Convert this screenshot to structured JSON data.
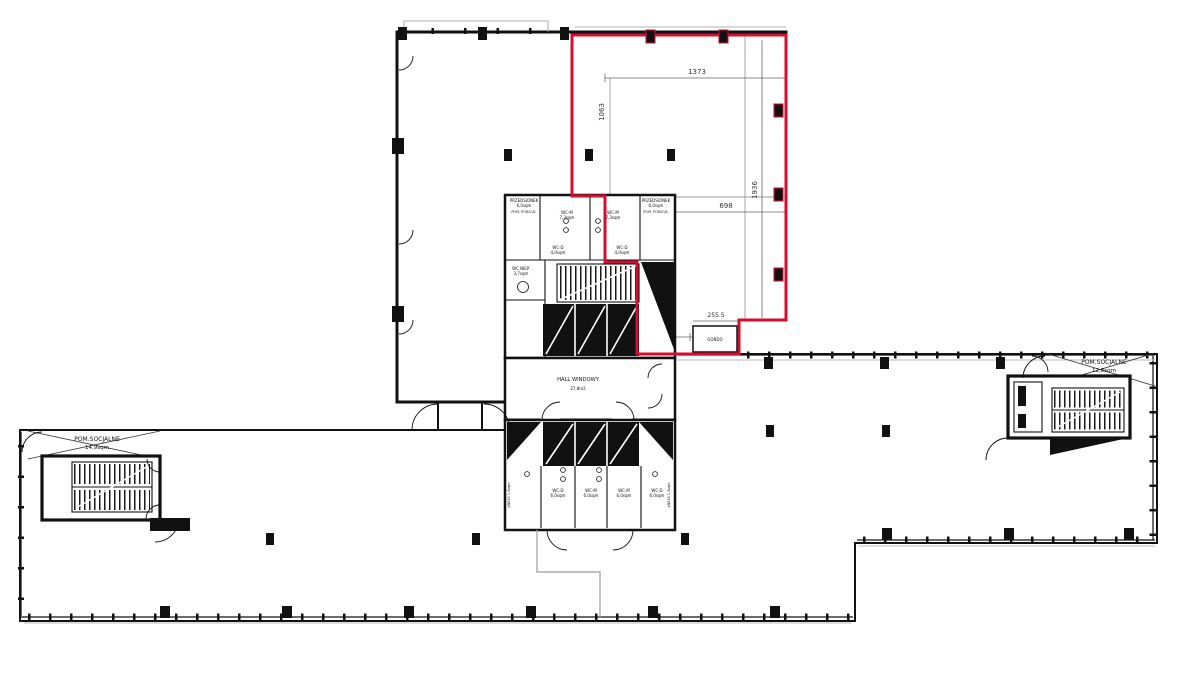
{
  "drawing": {
    "dimensions": {
      "d1373": "1373",
      "d1063": "1063",
      "d1936": "1936",
      "d698": "698",
      "d2555": "255.5",
      "d240": "240",
      "d150": "150",
      "d228": "228"
    },
    "rooms": {
      "hall_name": "HALL WINDOWY",
      "hall_area": "27,8m2",
      "social_left_name": "POM.SOCJALNE",
      "social_left_area": "14,9sqm",
      "social_right_name": "POM.SOCJALNE",
      "social_right_area": "12,8sqm",
      "gondola": "GONDO",
      "przedsionek_left_name": "PRZEDSIONEK",
      "przedsionek_left_area": "6,0sqm",
      "przedsionek_right_name": "PRZEDSIONEK",
      "przedsionek_right_area": "6,0sqm",
      "pom_porz_left": "POM. PORZĄD.",
      "pom_porz_right": "POM. PORZĄD.",
      "wc_m_upper_left_name": "WC-M",
      "wc_m_upper_left_area": "7,3sqm",
      "wc_m_upper_right_name": "WC-M",
      "wc_m_upper_right_area": "7,3sqm",
      "wc_d_upper_left_name": "WC-D",
      "wc_d_upper_left_area": "4,0sqm",
      "wc_d_upper_right_name": "WC-D",
      "wc_d_upper_right_area": "4,0sqm",
      "wc_niep_name": "WC NIEP.",
      "wc_niep_area": "3,7sqm",
      "aneks_left": "ANEKS 1,3sqm",
      "aneks_right": "ANEKS 1,3sqm",
      "lower_wc": [
        {
          "name": "WC-D",
          "area": "6,0sqm"
        },
        {
          "name": "WC-M",
          "area": "6,0sqm"
        },
        {
          "name": "WC-M",
          "area": "6,0sqm"
        },
        {
          "name": "WC-D",
          "area": "6,0sqm"
        }
      ]
    },
    "colors": {
      "outline": "#111111",
      "highlight": "#d40d2e",
      "grid": "#9a9a9a",
      "dim_text": "#333333"
    }
  }
}
